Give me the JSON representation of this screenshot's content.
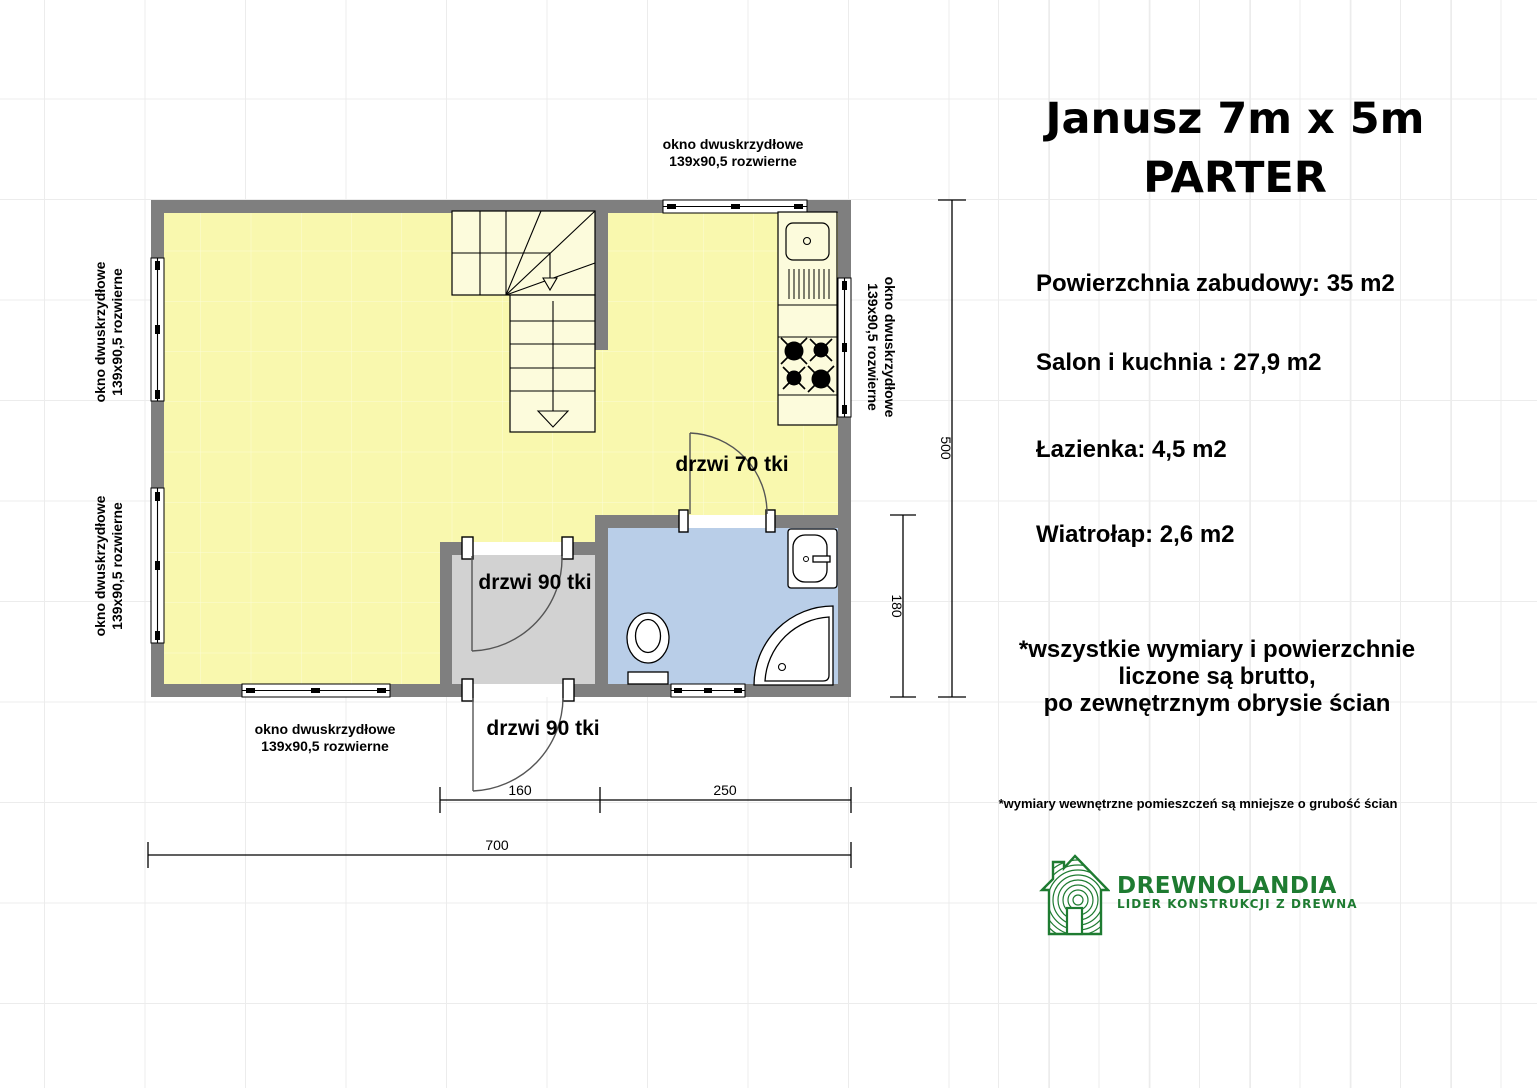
{
  "header": {
    "title": "Janusz 7m x 5m",
    "subtitle": "PARTER"
  },
  "stats": [
    "Powierzchnia zabudowy: 35 m2",
    "Salon i kuchnia : 27,9 m2",
    "Łazienka: 4,5 m2",
    "Wiatrołap: 2,6 m2"
  ],
  "notes": {
    "main_line1": "*wszystkie wymiary i powierzchnie",
    "main_line2": "liczone są brutto,",
    "main_line3": "po zewnętrznym obrysie ścian",
    "small": "*wymiary wewnętrzne pomieszczeń są mniejsze o grubość ścian"
  },
  "window_label": {
    "line1": "okno dwuskrzydłowe",
    "line2": "139x90,5 rozwierne"
  },
  "door_labels": {
    "bathroom": "drzwi 70 tki",
    "vestibule": "drzwi 90 tki",
    "entrance": "drzwi 90 tki"
  },
  "dimensions": {
    "total_height": "500",
    "bathroom_height": "180",
    "vestibule_width": "160",
    "bathroom_width": "250",
    "total_width": "700"
  },
  "logo": {
    "name": "DREWNOLANDIA",
    "tagline": "LIDER KONSTRUKCJI Z DREWNA"
  },
  "colors": {
    "wall": "#7f7f7f",
    "floor": "#f9f8ae",
    "bathroom": "#b9cee8",
    "vestibule": "#d2d2d2",
    "counter": "#fcfbdc",
    "logo_green": "#1e7b31",
    "grid": "#ececec"
  }
}
